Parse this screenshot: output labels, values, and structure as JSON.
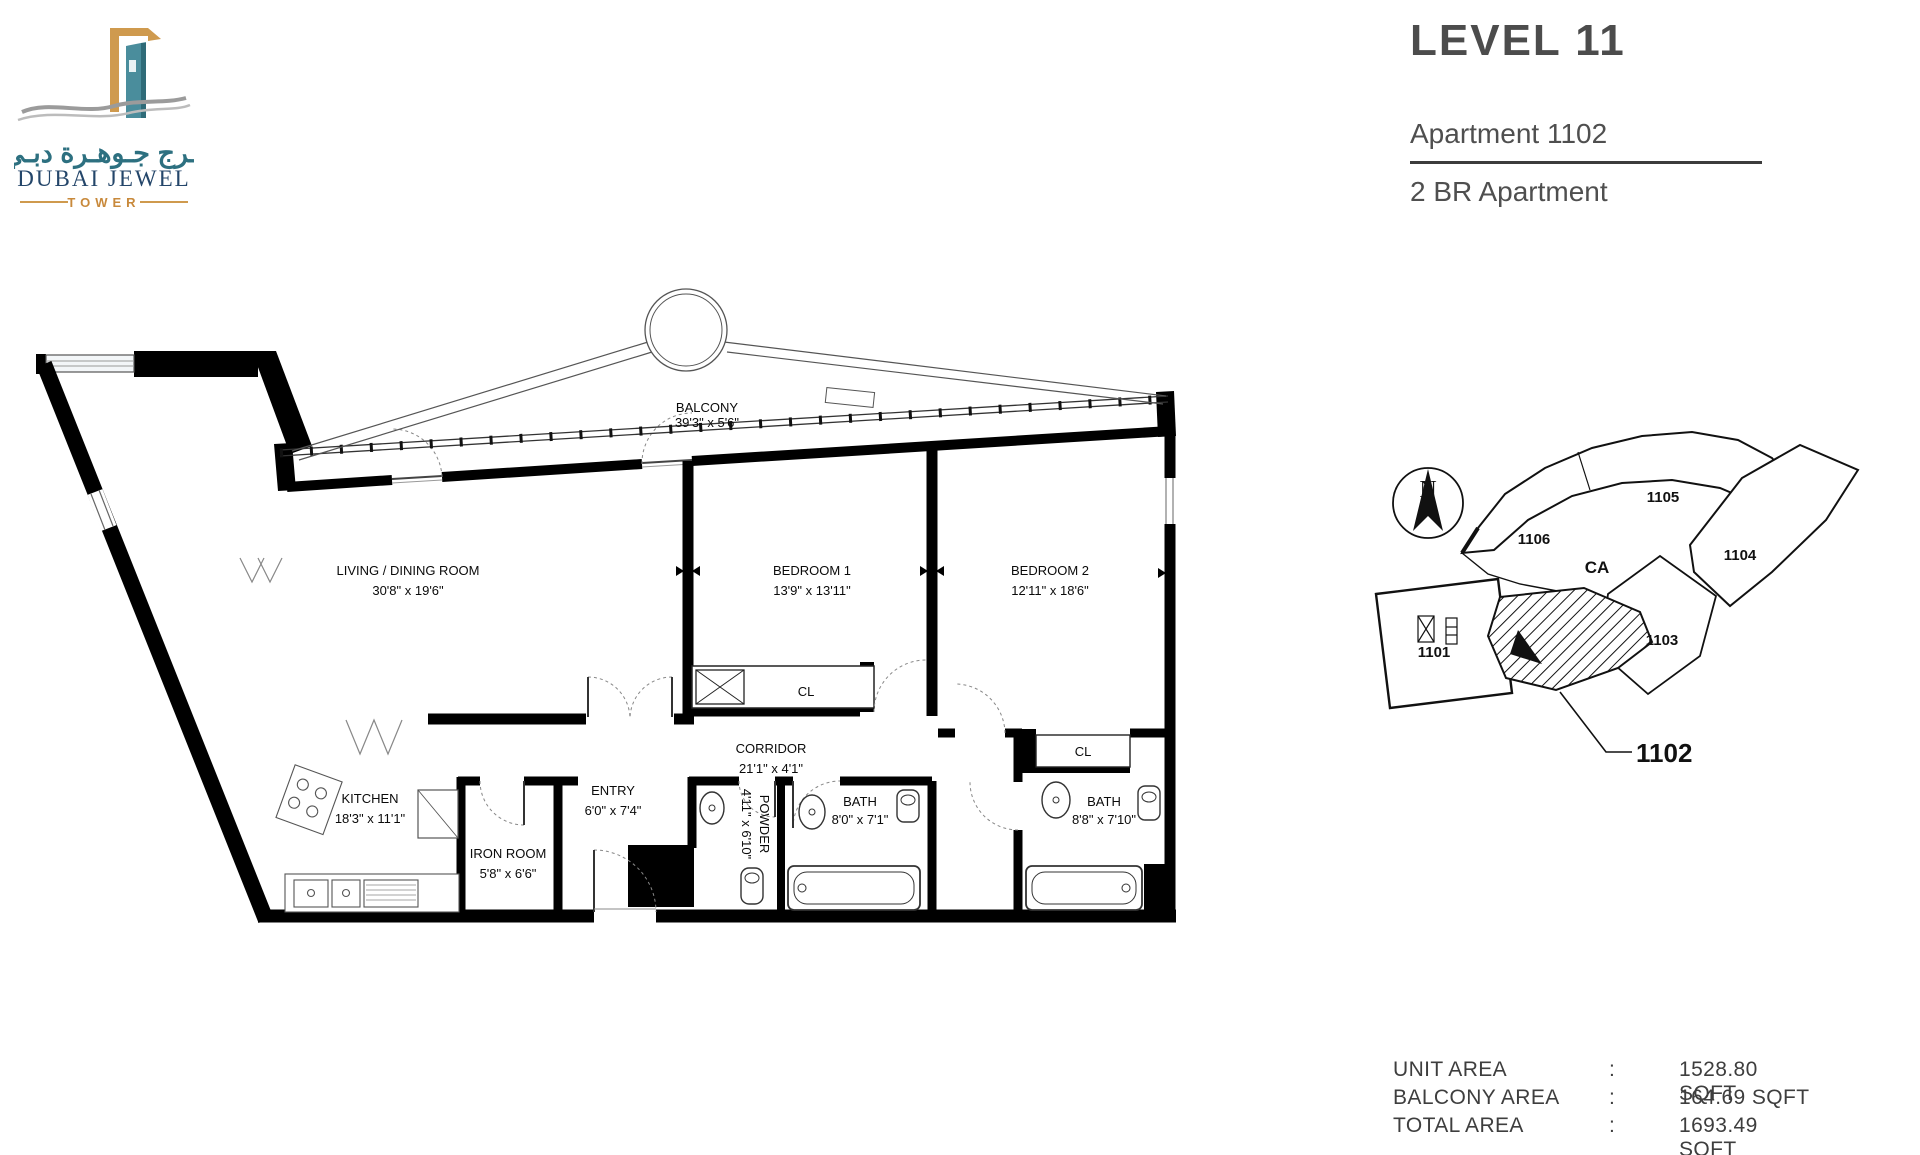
{
  "logo": {
    "arabic": "بـرج جـوهـرة دبـي",
    "name": "DUBAI JEWEL",
    "tagline": "TOWER",
    "colors": {
      "teal": "#2d7080",
      "gold": "#cf9a4e",
      "navy": "#24466a",
      "tower_teal": "#4a8d9c",
      "wave_gray": "#9b9b9b"
    }
  },
  "header": {
    "level": "LEVEL 11",
    "apartment": "Apartment 1102",
    "type": "2 BR Apartment"
  },
  "floor_plan": {
    "labels": [
      {
        "name": "BALCONY",
        "dims": "39'3\" x 5'6\""
      },
      {
        "name": "LIVING / DINING ROOM",
        "dims": "30'8\" x 19'6\""
      },
      {
        "name": "BEDROOM 1",
        "dims": "13'9\" x 13'11\""
      },
      {
        "name": "BEDROOM 2",
        "dims": "12'11\" x 18'6\""
      },
      {
        "name": "KITCHEN",
        "dims": "18'3\" x 11'1\""
      },
      {
        "name": "IRON ROOM",
        "dims": "5'8\" x 6'6\""
      },
      {
        "name": "ENTRY",
        "dims": "6'0\" x 7'4\""
      },
      {
        "name": "CORRIDOR",
        "dims": "21'1\" x 4'1\""
      },
      {
        "name": "POWDER",
        "dims": "4'11\" x 6'10\""
      },
      {
        "name": "BATH",
        "dims": "8'0\" x 7'1\""
      },
      {
        "name": "BATH",
        "dims": "8'8\" x 7'10\""
      },
      {
        "name": "CL"
      },
      {
        "name": "CL"
      }
    ]
  },
  "key_plan": {
    "north_label": "N",
    "units": [
      "1101",
      "1102",
      "1103",
      "1104",
      "1105",
      "1106"
    ],
    "common_area_label": "CA",
    "highlighted_unit": "1102"
  },
  "areas": {
    "rows": [
      {
        "label": "UNIT AREA",
        "separator": ":",
        "value": "1528.80 SQFT"
      },
      {
        "label": "BALCONY AREA",
        "separator": ":",
        "value": "164.69 SQFT"
      },
      {
        "label": "TOTAL AREA",
        "separator": ":",
        "value": "1693.49 SQFT"
      }
    ]
  }
}
